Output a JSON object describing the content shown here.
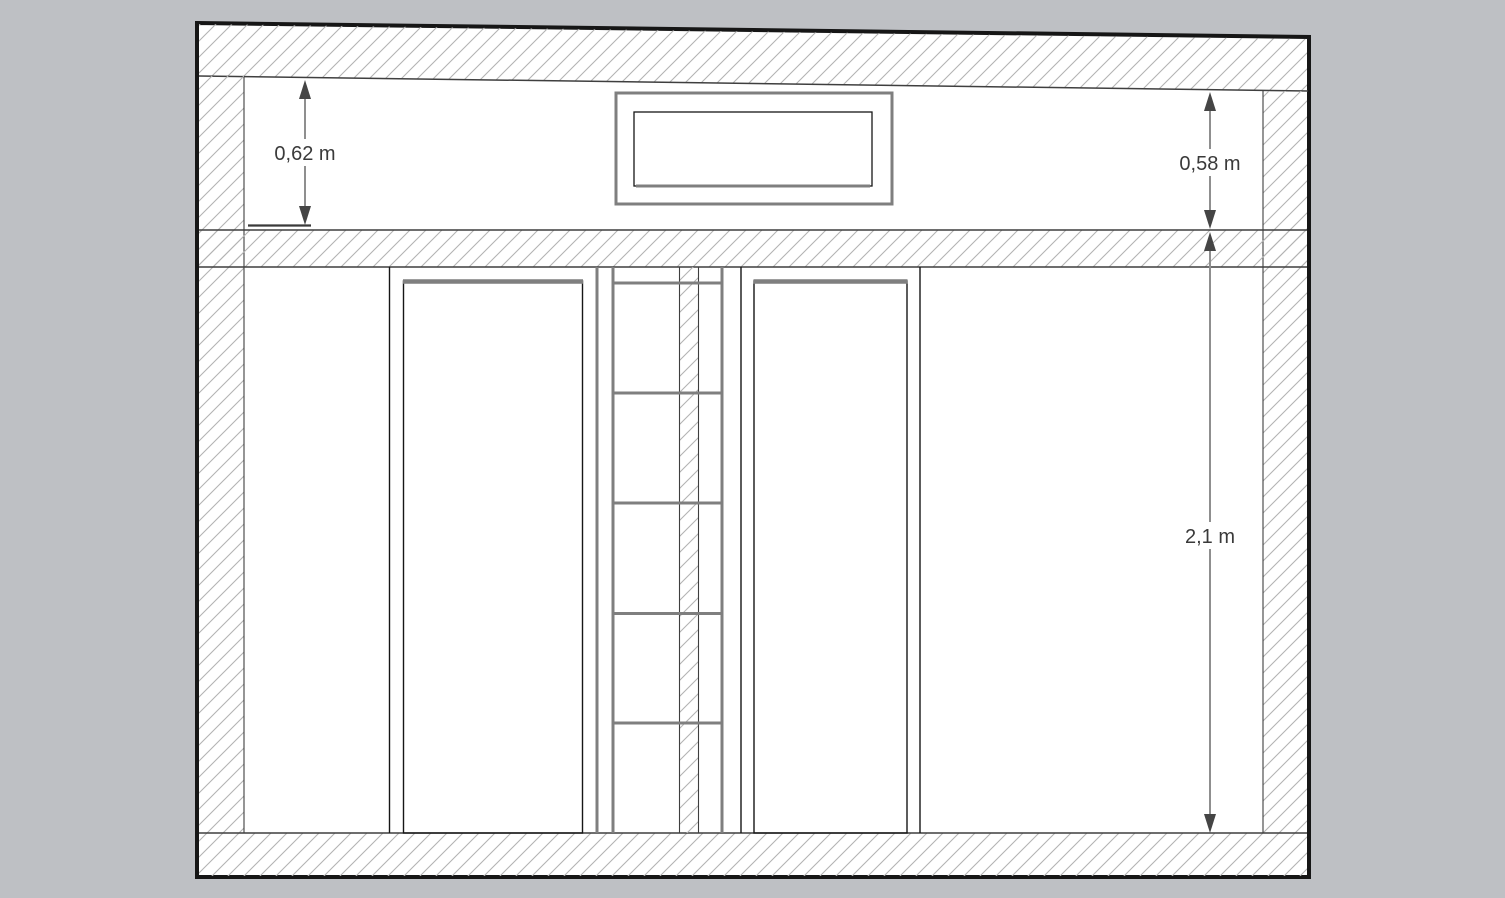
{
  "scene": {
    "background_color": "#bec0c4",
    "paper_color": "#ffffff",
    "outline_color": "#161616",
    "edge_color": "#3f3f3f",
    "frame_gray_color": "#7f7f7f",
    "hatch_color": "#b3b3b3",
    "dimension_line_color": "#8f8f8f",
    "arrow_color": "#454545",
    "text_color": "#3a3a3a"
  },
  "dimensions": [
    {
      "id": "transom-height-left",
      "label": "0,62 m"
    },
    {
      "id": "transom-height-right",
      "label": "0,58 m"
    },
    {
      "id": "opening-height",
      "label": "2,1 m"
    }
  ]
}
